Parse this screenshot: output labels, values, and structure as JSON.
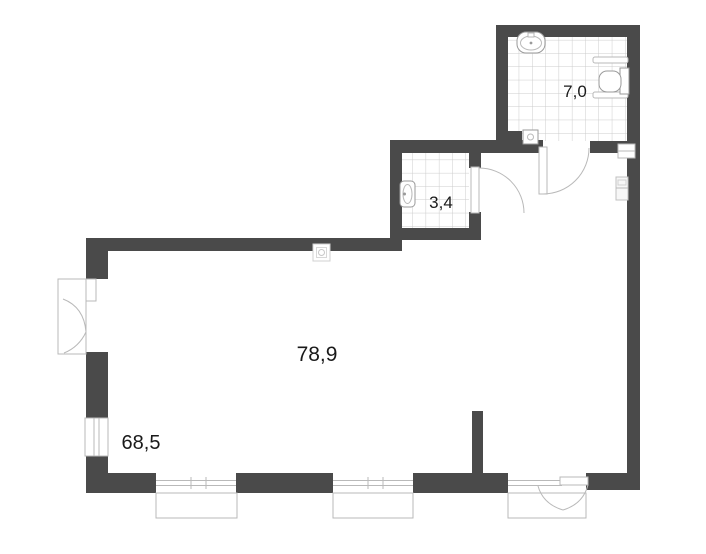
{
  "plan": {
    "type": "apartment-floor-plan",
    "rooms": [
      {
        "id": "main-room",
        "area_label": "78,9"
      },
      {
        "id": "lower-left-area",
        "area_label": "68,5"
      },
      {
        "id": "bathroom-top-right",
        "area_label": "7,0"
      },
      {
        "id": "bathroom-middle",
        "area_label": "3,4"
      }
    ],
    "colors": {
      "wall": "#4a4a4a",
      "tile_grid": "#cccccc",
      "fixture_outline": "#9a9a9a",
      "door_arc": "#b9b9b9",
      "label_text": "#1a1a1a"
    },
    "icons": [
      "sink-icon",
      "toilet-icon",
      "grab-bar-icon",
      "floor-drain-icon",
      "outlet-icon",
      "electrical-panel-icon",
      "duct-shaft-icon",
      "door-swing-arc",
      "window-frame",
      "balcony-box"
    ]
  }
}
